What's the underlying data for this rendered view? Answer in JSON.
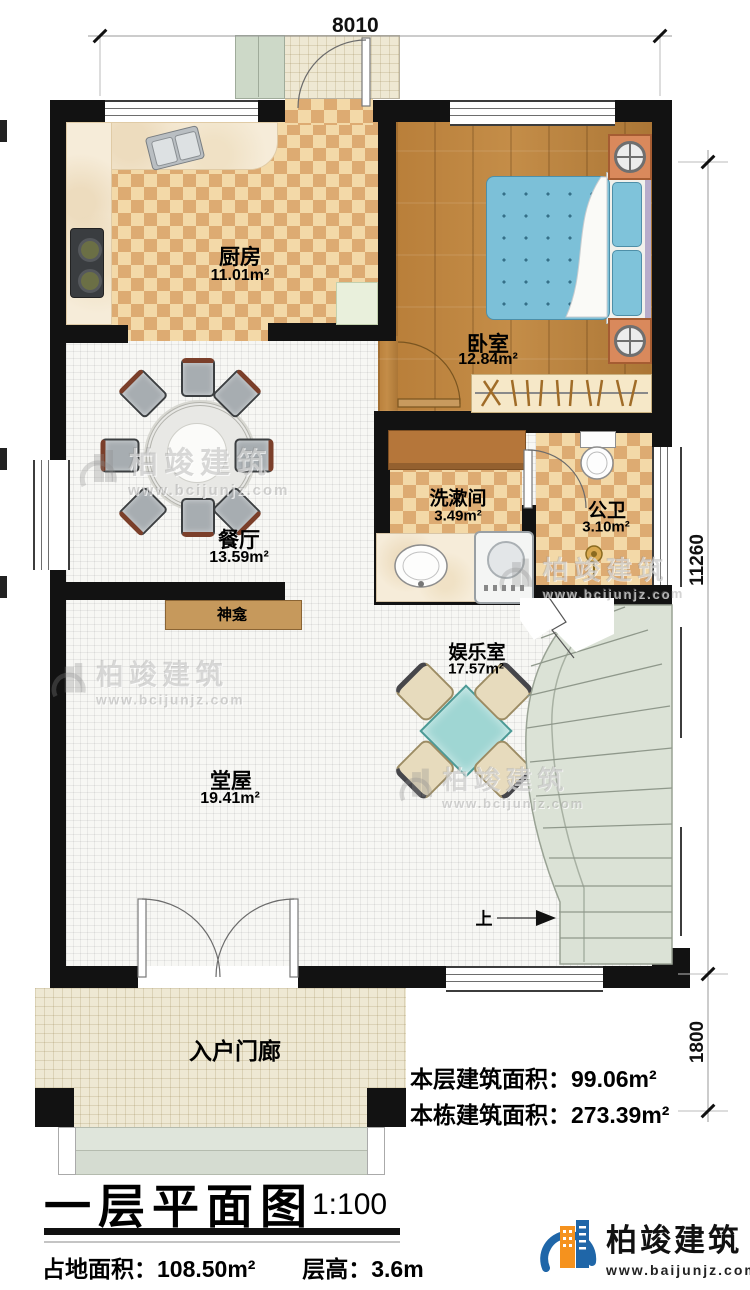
{
  "plan": {
    "dim_top": "8010",
    "dim_right_main": "11260",
    "dim_right_porch": "1800",
    "rooms": {
      "kitchen": {
        "name": "厨房",
        "area": "11.01m²"
      },
      "bedroom": {
        "name": "卧室",
        "area": "12.84m²"
      },
      "dining": {
        "name": "餐厅",
        "area": "13.59m²"
      },
      "washroom": {
        "name": "洗漱间",
        "area": "3.49m²"
      },
      "toilet": {
        "name": "公卫",
        "area": "3.10m²"
      },
      "shrine": {
        "name": "神龛"
      },
      "entertainment": {
        "name": "娱乐室",
        "area": "17.57m²"
      },
      "hall": {
        "name": "堂屋",
        "area": "19.41m²"
      },
      "porch": {
        "name": "入户门廊"
      }
    },
    "stairs_up": "上"
  },
  "annotations": {
    "floor_area_label": "本层建筑面积：",
    "floor_area_value": "99.06m²",
    "building_area_label": "本栋建筑面积：",
    "building_area_value": "273.39m²"
  },
  "titleblock": {
    "title": "一层平面图",
    "scale": "1:100",
    "site_area_label": "占地面积：",
    "site_area_value": "108.50m²",
    "floor_height_label": "层高：",
    "floor_height_value": "3.6m"
  },
  "brand": {
    "name": "柏竣建筑",
    "url": "www.baijunjz.com"
  },
  "watermark": {
    "name": "柏竣建筑",
    "url": "www.bcijunjz.com"
  },
  "colors": {
    "wall": "#121212",
    "checker_light": "#f3d9a8",
    "checker_dark": "#ddab72",
    "wood": "#b5813e",
    "bed_blue": "#7cc0d8",
    "stair_green": "#dbe2d6",
    "brand_blue": "#1f66a8",
    "brand_orange": "#f5921e"
  }
}
